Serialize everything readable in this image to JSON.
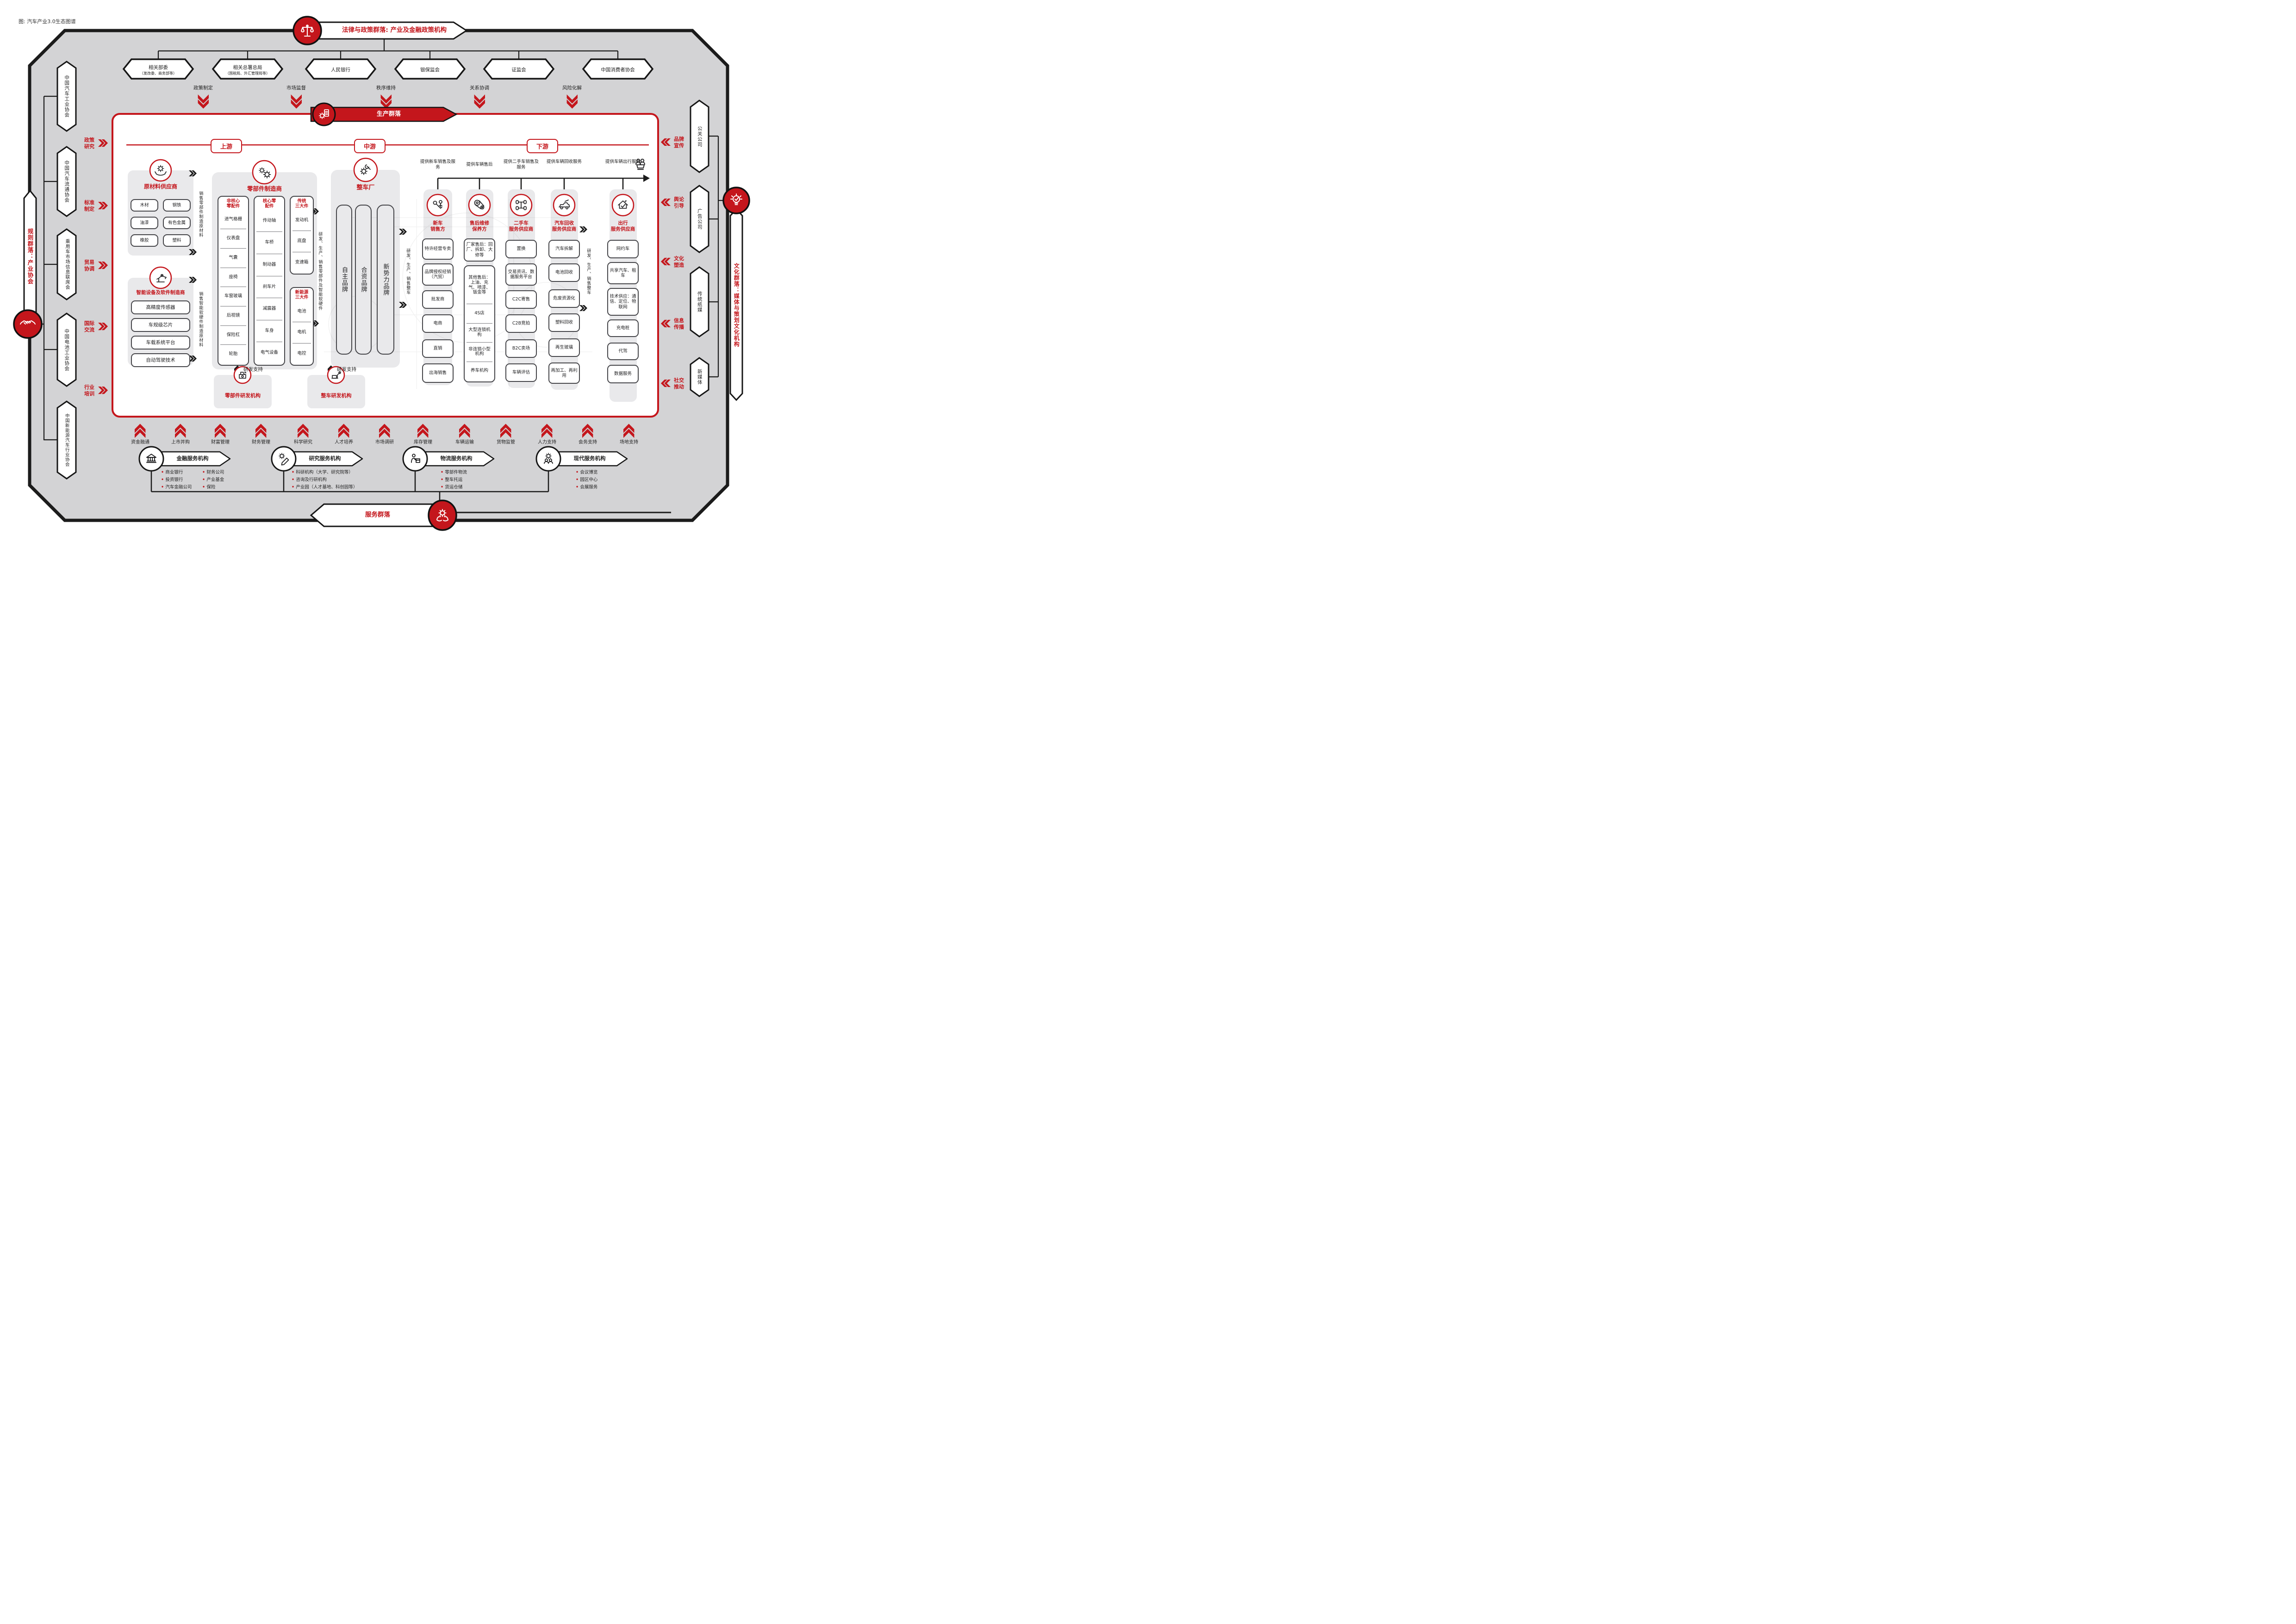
{
  "cap": "图: 汽车产业3.0生态图谱",
  "law": {
    "title": "法律与政策群落: 产业及金融政策机构",
    "orgs": [
      {
        "name": "相关部委",
        "sub": "（发改委、商务部等）"
      },
      {
        "name": "相关总署总局",
        "sub": "（国税局、外汇管理局等）"
      },
      {
        "name": "人民银行",
        "sub": ""
      },
      {
        "name": "银保监会",
        "sub": ""
      },
      {
        "name": "证监会",
        "sub": ""
      },
      {
        "name": "中国消费者协会",
        "sub": ""
      }
    ],
    "flows": [
      "政策制定",
      "市场监督",
      "秩序维持",
      "关系协调",
      "风险化解"
    ]
  },
  "rules": {
    "banner": "规则群落：产业协会",
    "orgs": [
      "中国汽车工业协会",
      "中国汽车流通协会",
      "乘用车市场信息联席会",
      "中国电池工业协会",
      "中国新能源汽车行业协会"
    ],
    "flows": [
      "政策研究",
      "标准制定",
      "贸易协调",
      "国际交流",
      "行业培训"
    ]
  },
  "cul": {
    "banner": "文化群落：媒体与策划文化机构",
    "orgs": [
      "公关公司",
      "广告公司",
      "传统纸媒",
      "新媒体"
    ],
    "flows": [
      "品牌宣传",
      "舆论引导",
      "文化塑造",
      "信息传播",
      "社交推动"
    ]
  },
  "prod": {
    "banner": "生产群落",
    "stages": [
      "上游",
      "中游",
      "下游"
    ],
    "raw": {
      "title": "原材料供应商",
      "items": [
        "木材",
        "钢铁",
        "油漆",
        "有色金属",
        "橡胶",
        "塑料"
      ]
    },
    "smart": {
      "title": "智能设备及软件制造商",
      "items": [
        "高精度传感器",
        "车规级芯片",
        "车载系统平台",
        "自动驾驶技术"
      ]
    },
    "parts": {
      "title": "零部件制造商",
      "cols": [
        {
          "t1": "非核心",
          "t2": "零配件",
          "items": [
            "进气格栅",
            "仪表盘",
            "气囊",
            "座椅",
            "车窗玻璃",
            "后视镜",
            "保险杠",
            "轮胎"
          ]
        },
        {
          "t1": "核心零",
          "t2": "配件",
          "items": [
            "传动轴",
            "车桥",
            "制动器",
            "刹车片",
            "减震器",
            "车身",
            "电气设备"
          ]
        },
        {
          "t1": "传统",
          "t2": "三大件",
          "items": [
            "发动机",
            "底盘",
            "变速箱"
          ]
        },
        {
          "t1": "新能源",
          "t2": "三大件",
          "items": [
            "电池",
            "电机",
            "电控"
          ]
        }
      ]
    },
    "oem": {
      "title": "整车厂",
      "items": [
        "自主品牌",
        "合资品牌",
        "新势力品牌"
      ]
    },
    "heads": [
      "提供新车销售及服务",
      "提供车辆售后",
      "提供二手车销售及服务",
      "提供车辆回收服务",
      "提供车辆出行服务"
    ],
    "cols": [
      {
        "t1": "新车",
        "t2": "销售方",
        "items": [
          "特许经营专卖",
          "品牌授权经销（汽贸）",
          "批发商",
          "电商",
          "直销",
          "出海销售"
        ]
      },
      {
        "t1": "售后维修",
        "t2": "保养方",
        "box1": "厂家售后：回厂、拆卸、大修等",
        "items": [
          "其他售后：上油、充气、喷漆、钣金等",
          "4S店",
          "大型连锁机构",
          "非连锁小型机构",
          "养车机构"
        ]
      },
      {
        "t1": "二手车",
        "t2": "服务供应商",
        "items": [
          "置换",
          "交易资讯、数据服务平台",
          "C2C寄售",
          "C2B竞拍",
          "B2C卖场",
          "车辆评估"
        ]
      },
      {
        "t1": "汽车回收",
        "t2": "服务供应商",
        "items": [
          "汽车拆解",
          "电池回收",
          "危废资源化",
          "塑料回收",
          "再生玻璃",
          "再加工、再利用"
        ]
      },
      {
        "t1": "出行",
        "t2": "服务供应商",
        "items": [
          "网约车",
          "共享汽车、租车",
          "技术供应：通信、定位、物联网",
          "充电桩",
          "代驾",
          "数据服务"
        ]
      }
    ],
    "flows": {
      "sellParts": "销售零部件制造原材料",
      "sellSmart": "销售智能软硬件制造原材料",
      "rndParts": "研发、生产、销售零部件及智能软硬件",
      "rndOem": "研发、生产、销售整车",
      "support": "研发支持"
    },
    "research": {
      "parts": "零部件研发机构",
      "oem": "整车研发机构"
    }
  },
  "svc": {
    "banner": "服务群落",
    "flows": [
      "资金融通",
      "上市并购",
      "财富管理",
      "财务管理",
      "科学研究",
      "人才培养",
      "市场调研",
      "库存管理",
      "车辆运输",
      "货物监管",
      "人力支持",
      "会务支持",
      "场地支持"
    ],
    "groups": [
      {
        "title": "金融服务机构",
        "col1": [
          "商业银行",
          "投资银行",
          "汽车金融公司"
        ],
        "col2": [
          "财务公司",
          "产业基金",
          "保险"
        ]
      },
      {
        "title": "研究服务机构",
        "items": [
          "科研机构（大学、研究院等）",
          "咨询及行研机构",
          "产业园（人才基地、科创园等）"
        ]
      },
      {
        "title": "物流服务机构",
        "items": [
          "零部件物流",
          "整车托运",
          "货运仓储"
        ]
      },
      {
        "title": "现代服务机构",
        "items": [
          "会议博览",
          "园区中心",
          "会展服务"
        ]
      }
    ]
  },
  "colors": {
    "red": "#c4161c",
    "dark": "#1b1b1b",
    "panel": "#d3d3d5"
  }
}
